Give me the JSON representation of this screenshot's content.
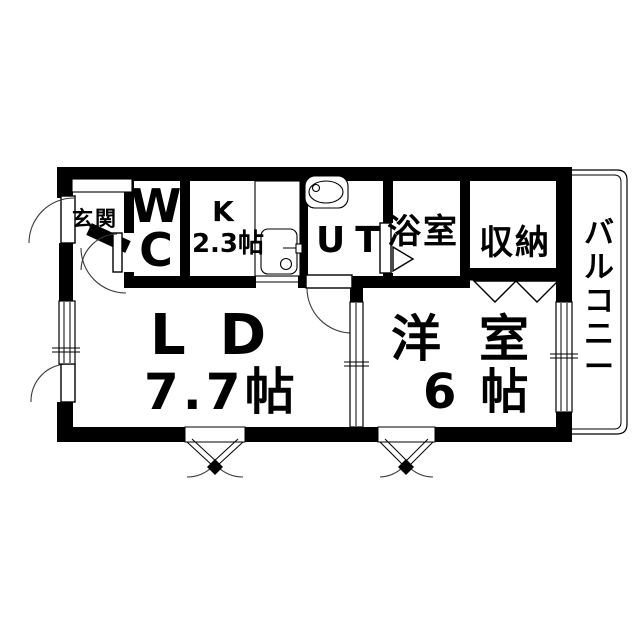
{
  "colors": {
    "wall": "#000000",
    "background": "#ffffff",
    "line": "#000000"
  },
  "rooms": {
    "genkan": {
      "label": "玄関"
    },
    "wc": {
      "label": "WC",
      "lines": [
        "W",
        "C"
      ]
    },
    "kitchen": {
      "label": "K",
      "size": "2.3帖"
    },
    "utility": {
      "label": "UT"
    },
    "bathroom": {
      "label": "浴室"
    },
    "closet": {
      "label": "収納"
    },
    "balcony": {
      "label": "バルコニー",
      "chars": [
        "バ",
        "ル",
        "コ",
        "ニ",
        "ー"
      ]
    },
    "living_dining": {
      "label": "LD",
      "size": "7.7帖"
    },
    "western_room": {
      "label": "洋室",
      "size": "6帖"
    }
  }
}
